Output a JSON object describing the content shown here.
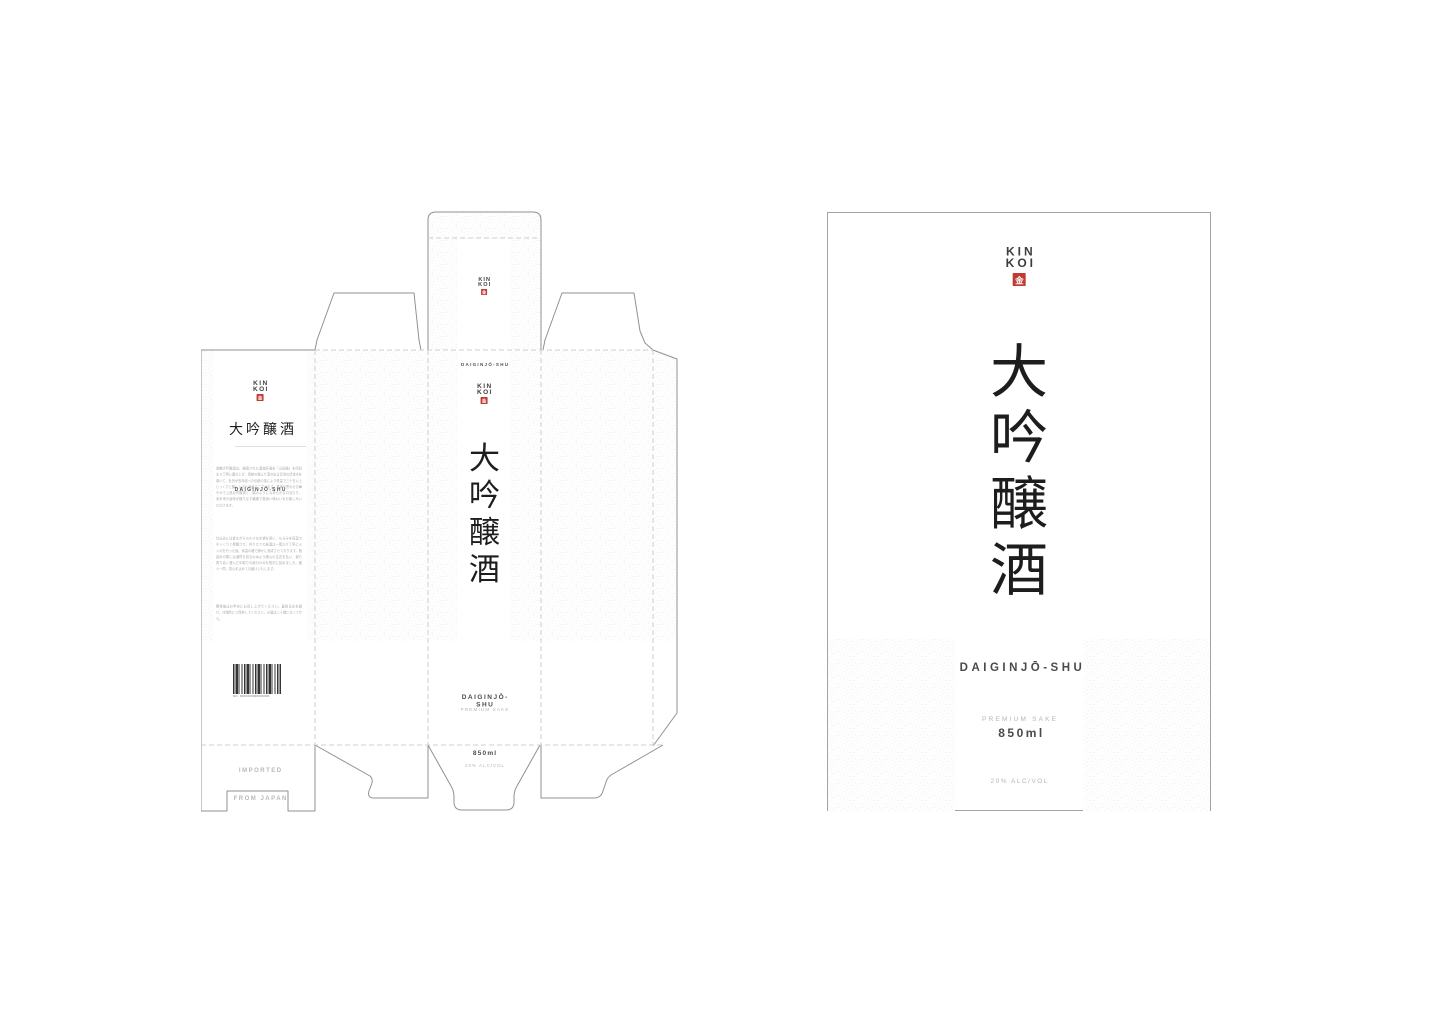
{
  "meta": {
    "description": "Sake carton packaging presentation: dieline layout (left) and front panel mockup (right)",
    "background": "#ffffff"
  },
  "colors": {
    "ink": "#1d1d1d",
    "brand_dark": "#3e3e3e",
    "seal_red": "#bf3a31",
    "cut_line": "#919191",
    "fold_line_dashed": "#cfcfcf",
    "pattern_wave": "#e4e4e4",
    "text_mid": "#4a4a4a",
    "text_light": "#b5b5b5",
    "text_body": "#a8a8a8"
  },
  "brand": {
    "name_line1": "KIN",
    "name_line2": "KOI",
    "seal_glyph": "金"
  },
  "product": {
    "kanji_title": "大吟醸酒",
    "kanji_chars": [
      "大",
      "吟",
      "醸",
      "酒"
    ],
    "romaji": "DAIGINJŌ-SHU",
    "descriptor": "PREMIUM SAKE",
    "volume": "850ml",
    "abv": "20% ALC/VOL"
  },
  "dieline": {
    "back_panel": {
      "paragraphs": [
        "金鯉大吟醸酒は、厳選された酒造好適米「山田錦」を四割まで丁寧に磨き上げ、霊峰の麓より湧き出る清冽な伏流水を用いて、杜氏が長年培った伝統の技により低温で三十日以上じっくりと醸し上げた逸品でございます。果実を思わせる華やかで上品な吟醸香と、絹のようになめらかな口当たり、米本来の旨味が織りなす繊細で奥深い味わいをお楽しみいただけます。",
        "仕込みには昔ながらの小さな木槽を用い、もろみを低温でゆっくりと発酵させ、搾りたての原酒は一度だけ丁寧に火入れを行った後、氷温の蔵で静かに熟成させております。瓶詰めの際には酒質を損なわぬよう細心の注意を払い、最も香り高く澄んだ中取りの部分のみを贅沢に詰めました。蔵人一同、真心を込めてお届けいたします。",
        "開栓後はお早めにお召し上がりください。直射日光を避け、冷暗所にて保存してください。お酒は二十歳になってから。"
      ],
      "barcode_label": "NO. 0000000000000000",
      "imported_line1": "IMPORTED",
      "imported_line2": "FROM JAPAN"
    }
  }
}
